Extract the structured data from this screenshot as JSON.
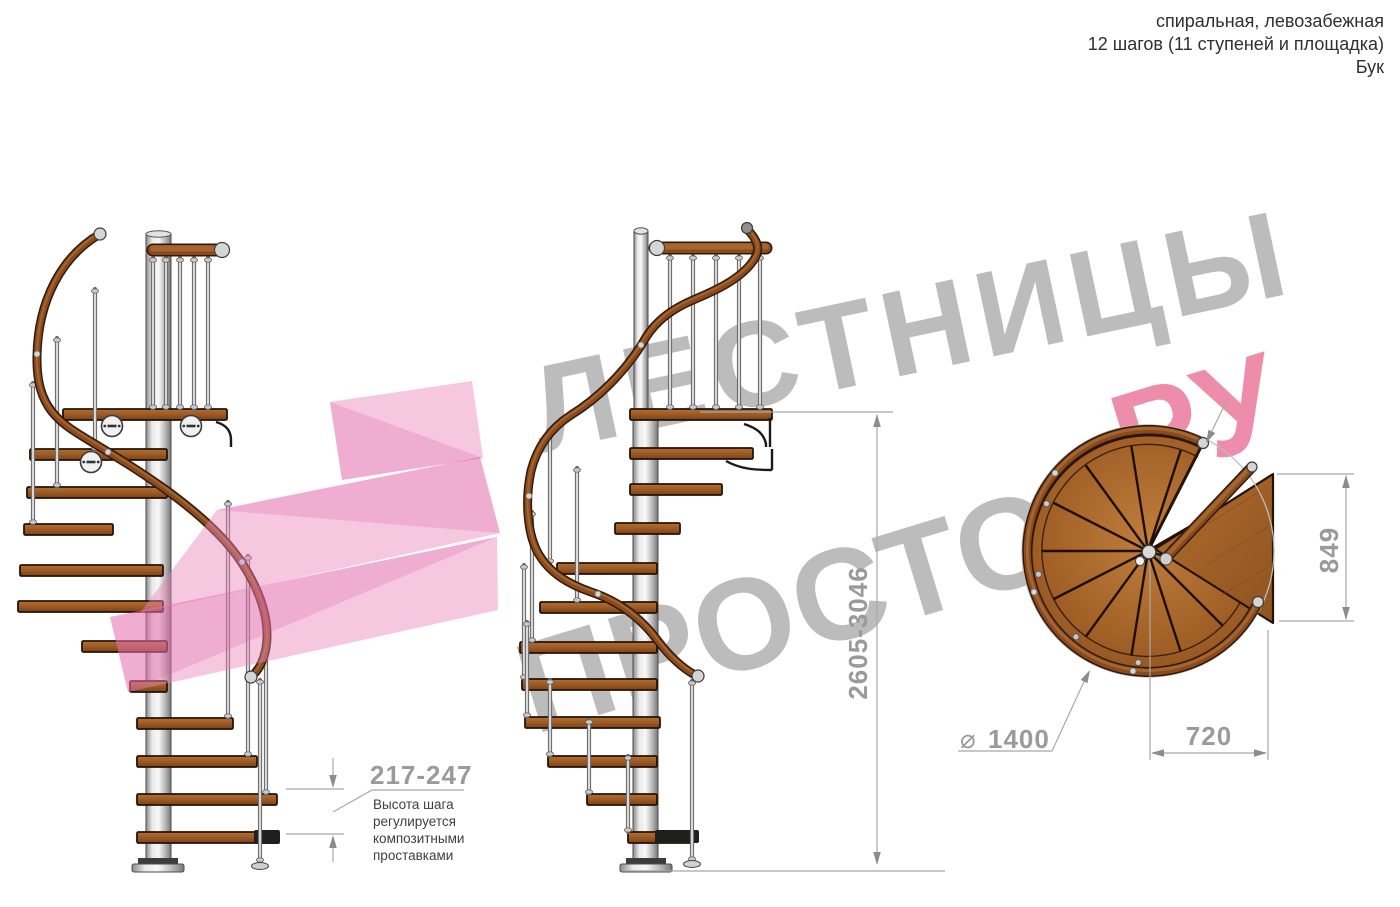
{
  "title": {
    "line1": "спиральная, левозабежная",
    "line2": "12 шагов (11 ступеней и площадка)",
    "line3": "Бук"
  },
  "watermark": {
    "line1": "ЛЕСТНИЦЫ",
    "line2_gray": "ПРОСТО",
    "line2_pink": ".РУ",
    "gray_color": "#bcbcbc",
    "pink_color": "#ee8cab"
  },
  "dimensions": {
    "total_height": "2605-3046",
    "step_height": "217-247",
    "landing_depth": "849",
    "landing_width": "720",
    "diameter_symbol": "⌀",
    "diameter_value": "1400"
  },
  "note": {
    "lines": [
      "Высота шага",
      "регулируется",
      "композитными",
      "проставками"
    ]
  },
  "colors": {
    "wood": "#9c5a24",
    "wood_dark": "#241207",
    "handrail": "#8a4a1e",
    "metal_pole": "#d9d9d9",
    "dimension_gray": "#9a9a9a",
    "note_text": "#3f3f3f",
    "title_text": "#2f2f2f",
    "logo_pink": "#ec86bb"
  }
}
